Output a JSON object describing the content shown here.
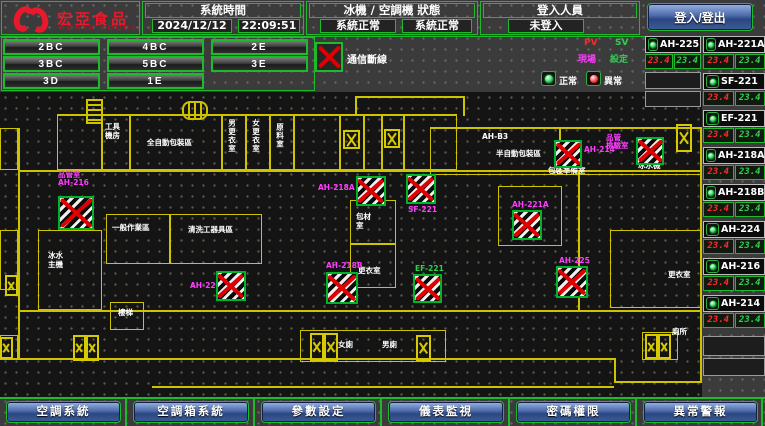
{
  "brand": {
    "zh": "宏亞食品",
    "en": "HUNYA FOODS"
  },
  "header": {
    "time_label": "系統時間",
    "date": "2024/12/12",
    "time": "22:09:51",
    "status_label": "冰機 / 空調機 狀態",
    "chiller_status": "系統正常",
    "ac_status": "系統正常",
    "login_label": "登入人員",
    "login_value": "未登入",
    "login_button": "登入/登出"
  },
  "floors": {
    "b1": "2BC",
    "b2": "4BC",
    "b3": "2E",
    "b4": "3BC",
    "b5": "5BC",
    "b6": "3E",
    "b7": "3D",
    "b8": "1E"
  },
  "comm": {
    "label": "通信斷線"
  },
  "legend": {
    "pv": "PV",
    "sv": "SV",
    "site": "現場",
    "set": "設定",
    "normal": "正常",
    "abnormal": "異常"
  },
  "equipment": [
    {
      "name": "AH-225",
      "pv": "23.4",
      "sv": "23.4"
    },
    {
      "name": "AH-221A",
      "pv": "23.4",
      "sv": "23.4"
    },
    {
      "name": "SF-221",
      "pv": "23.4",
      "sv": "23.4"
    },
    {
      "name": "EF-221",
      "pv": "23.4",
      "sv": "23.4"
    },
    {
      "name": "AH-218A",
      "pv": "23.4",
      "sv": "23.4"
    },
    {
      "name": "AH-218B",
      "pv": "23.4",
      "sv": "23.4"
    },
    {
      "name": "AH-224",
      "pv": "23.4",
      "sv": "23.4"
    },
    {
      "name": "AH-216",
      "pv": "23.4",
      "sv": "23.4"
    },
    {
      "name": "AH-214",
      "pv": "23.4",
      "sv": "23.4"
    }
  ],
  "plan": {
    "rooms": [
      "工具機房",
      "全自動包裝區",
      "男更衣室",
      "女更衣室",
      "原料室",
      "AH-B3",
      "半自動包裝區",
      "包裝準備室",
      "冰水機",
      "一般作業區",
      "清洗工器具區",
      "包材室",
      "更衣室",
      "冰水主機",
      "樓梯",
      "女廁",
      "男廁",
      "更衣室",
      "廁所"
    ],
    "devices": [
      {
        "l1": "品管室",
        "l2": "AH-216"
      },
      {
        "l1": "AH-218A"
      },
      {
        "l1": "SF-221"
      },
      {
        "l1": "AH-214"
      },
      {
        "l1": "品管",
        "l2": "檢驗室"
      },
      {
        "l1": "AH-221A"
      },
      {
        "l1": "AH-218B"
      },
      {
        "l1": "EF-221"
      },
      {
        "l1": "AH-225"
      },
      {
        "l1": "AH-224"
      }
    ]
  },
  "nav": {
    "b1": "空調系統",
    "b2": "空調箱系統",
    "b3": "參數設定",
    "b4": "儀表監視",
    "b5": "密碼權限",
    "b6": "異常警報"
  },
  "colors": {
    "accent_green": "#1dbb2c",
    "alarm_red": "#e00000",
    "label_magenta": "#ff3cff",
    "pv_red": "#ff2a2a",
    "sv_green": "#2fd04e",
    "wall_yellow": "#cfc300",
    "brand_red": "#e8192c"
  }
}
